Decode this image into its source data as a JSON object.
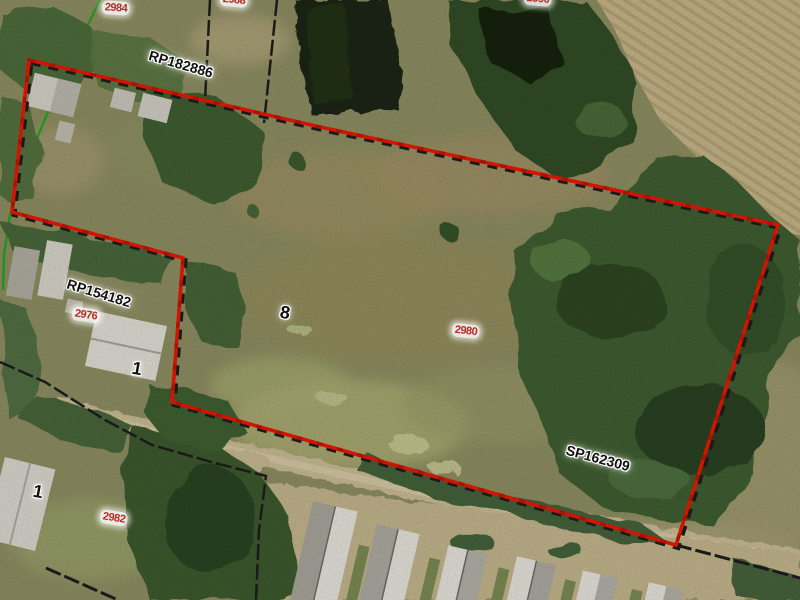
{
  "map": {
    "plan_labels": [
      {
        "text": "RP182886"
      },
      {
        "text": "RP154182"
      },
      {
        "text": "SP162309"
      }
    ],
    "lot_labels": [
      {
        "text": "8"
      },
      {
        "text": "1"
      },
      {
        "text": "1"
      }
    ],
    "parcel_labels": [
      {
        "text": "2984"
      },
      {
        "text": "2988"
      },
      {
        "text": "2990"
      },
      {
        "text": "2976"
      },
      {
        "text": "2980"
      },
      {
        "text": "2982"
      }
    ],
    "legend": {
      "selected_boundary_color": "#d01503",
      "cadastral_boundary_color": "#1a1a1a",
      "other_boundary_color": "#1fa51f",
      "parcel_label_color": "#b52b2b",
      "text_label_color": "#111111"
    }
  }
}
